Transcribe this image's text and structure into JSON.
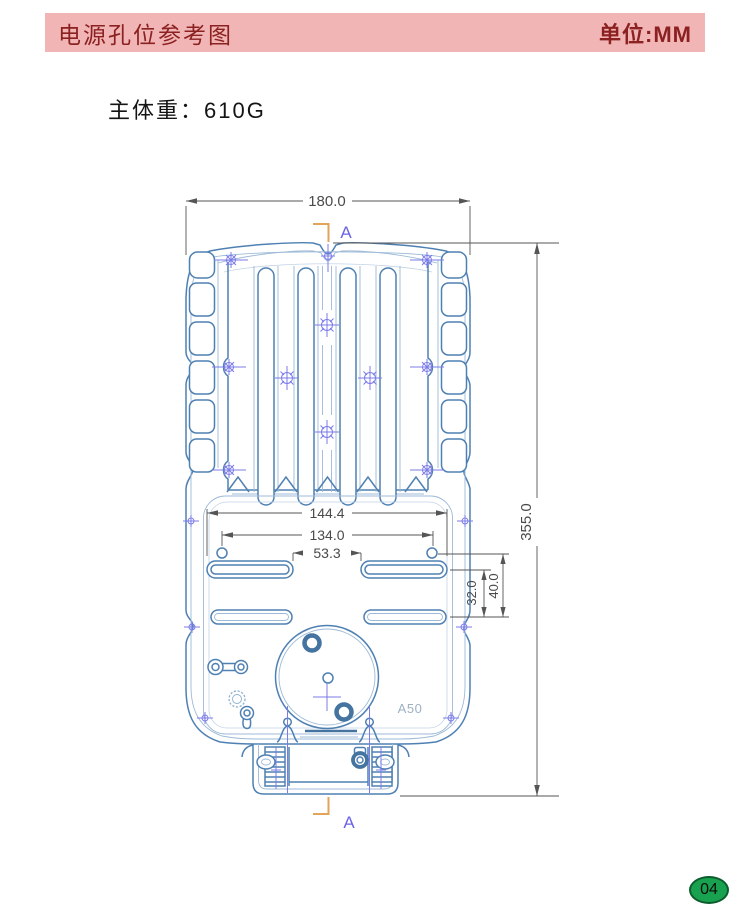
{
  "header": {
    "title": "电源孔位参考图",
    "unit_label": "单位:MM",
    "bg_color": "#f2b5b5",
    "text_color": "#8b2121"
  },
  "subtitle": {
    "weight_label": "主体重：610G"
  },
  "drawing": {
    "dimensions": {
      "overall_width": "180.0",
      "overall_height": "355.0",
      "slot_outer_width": "144.4",
      "hole_spacing": "134.0",
      "slot_inner_gap": "53.3",
      "slot_row_spacing": "32.0",
      "hole_to_row_spacing": "40.0"
    },
    "section_marker_top": "A",
    "section_marker_bottom": "A",
    "part_label": "A50",
    "colors": {
      "outline": "#4e80b2",
      "outline_light": "#9dbad8",
      "centerline": "#7b7bea",
      "dimension": "#555555",
      "section_bracket": "#e2a35a",
      "section_letter": "#6b63e6",
      "part_label_color": "#9eb0c2"
    }
  },
  "footer": {
    "page_number": "04",
    "badge_color": "#18a24f"
  }
}
